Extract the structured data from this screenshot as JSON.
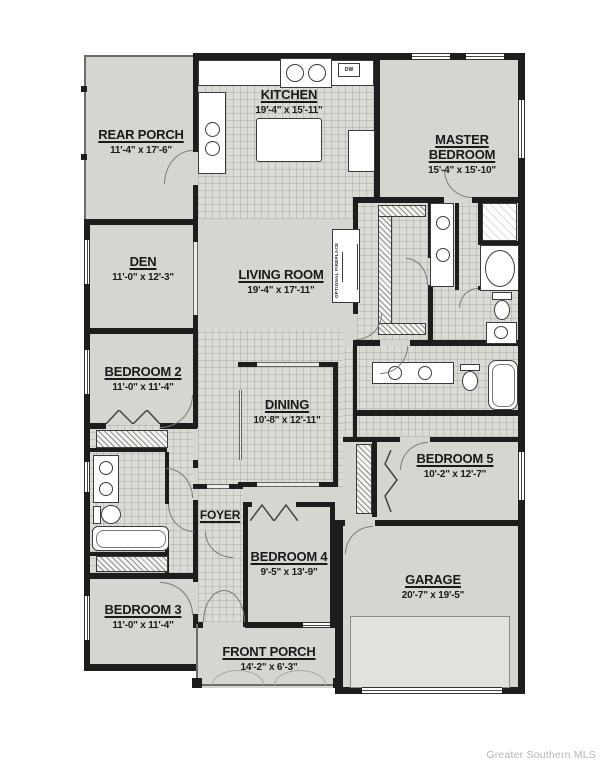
{
  "plan": {
    "watermark": "Greater Southern MLS",
    "rooms": [
      {
        "id": "rear-porch",
        "name": "REAR PORCH",
        "dims": "11'-4\" x 17'-6\""
      },
      {
        "id": "kitchen",
        "name": "KITCHEN",
        "dims": "19'-4\" x 15'-11\""
      },
      {
        "id": "master",
        "name": "MASTER BEDROOM",
        "dims": "15'-4\" x 15'-10\""
      },
      {
        "id": "den",
        "name": "DEN",
        "dims": "11'-0\" x 12'-3\""
      },
      {
        "id": "living",
        "name": "LIVING ROOM",
        "dims": "19'-4\" x 17'-11\""
      },
      {
        "id": "bedroom-2",
        "name": "BEDROOM 2",
        "dims": "11'-0\" x 11'-4\""
      },
      {
        "id": "dining",
        "name": "DINING",
        "dims": "10'-8\" x 12'-11\""
      },
      {
        "id": "bedroom-5",
        "name": "BEDROOM 5",
        "dims": "10'-2\" x 12'-7\""
      },
      {
        "id": "foyer",
        "name": "FOYER",
        "dims": ""
      },
      {
        "id": "bedroom-4",
        "name": "BEDROOM 4",
        "dims": "9'-5\" x 13'-9\""
      },
      {
        "id": "bedroom-3",
        "name": "BEDROOM 3",
        "dims": "11'-0\" x 11'-4\""
      },
      {
        "id": "garage",
        "name": "GARAGE",
        "dims": "20'-7\" x 19'-5\""
      },
      {
        "id": "front-porch",
        "name": "FRONT PORCH",
        "dims": "14'-2\" x 6'-3\""
      }
    ],
    "annotations": {
      "dishwasher": "DW",
      "fireplace": "OPTIONAL FIREPLACE"
    },
    "colors": {
      "floor": "#d7d5d0",
      "tile": "#dcdad5",
      "wall": "#1d1d1d",
      "fixture_stroke": "#3c3c3c",
      "door_arc": "#7a7a7a",
      "watermark": "#b6b6b6"
    }
  }
}
